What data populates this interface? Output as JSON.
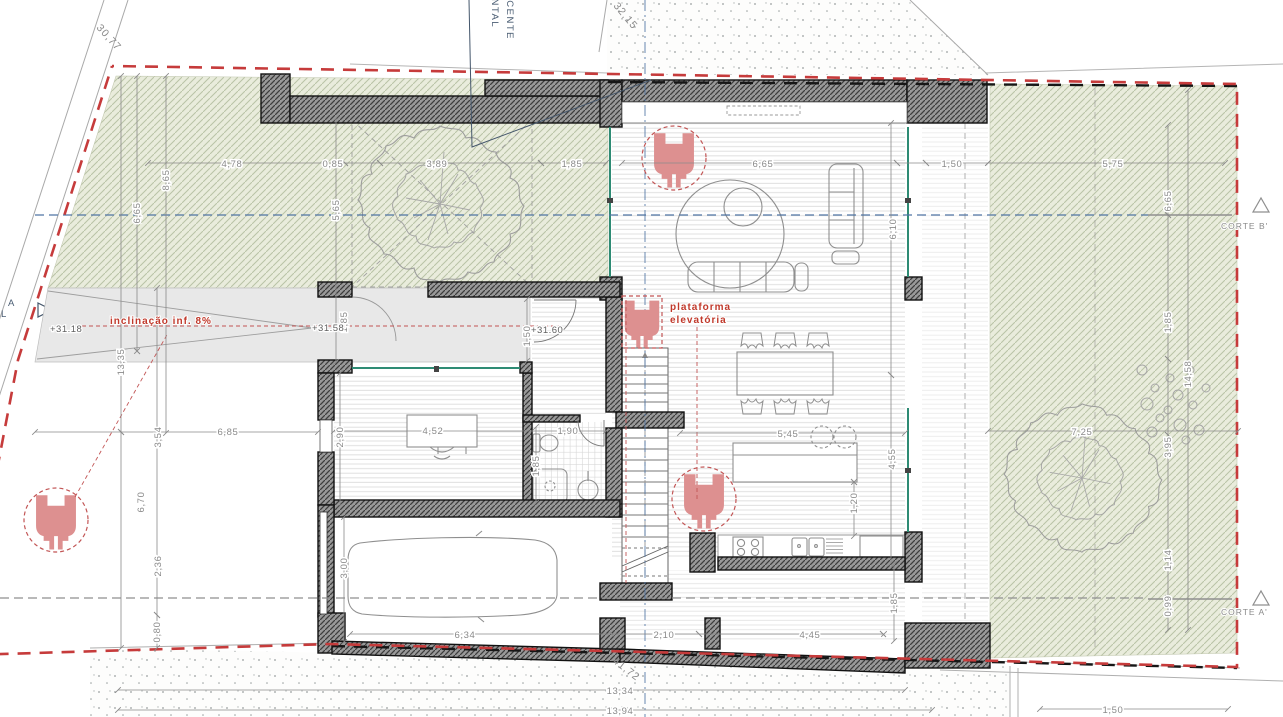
{
  "drawing": {
    "type": "architectural floor plan (ground floor with site)",
    "colors": {
      "boundary_red": "#c63b3b",
      "garden_fill": "#e9ecdc",
      "garden_hatch": "#b9c3a6",
      "wall_fill": "#8f8f8f",
      "wall_hatch": "#3d3d3d",
      "accessibility_red": "#dd9090",
      "note_red": "#c0392b",
      "section_blue": "#4f74a3",
      "glazing_green": "#2e8b74",
      "dim_gray": "#8a8a8a"
    }
  },
  "texts": {
    "frontal": "FRONTAL",
    "adjacente": "ADJACENTE",
    "inclinacao": "inclinação  inf.  8%",
    "plataforma_l1": "plataforma",
    "plataforma_l2": "elevatória",
    "corte_b": "CORTE  B'",
    "corte_a": "CORTE  A'",
    "edge_a": "A",
    "edge_l": "L"
  },
  "levels": {
    "ramp_start": "+31.18",
    "ramp_end": "+31.58",
    "entry_hall": "+31.60"
  },
  "dims": {
    "site_street_left": "30,77",
    "site_street_top": "32,15",
    "site_street_bottom": "41,72",
    "garden_top_1": "4,78",
    "garden_top_2": "0,85",
    "garden_top_3": "3,89",
    "garden_top_4": "1,85",
    "living_width": "6,65",
    "living_east_gap": "1,50",
    "garden_right_top": "5,75",
    "left_v1": "6,65",
    "left_v2": "8,65",
    "left_total": "13,35",
    "garden_sq_h": "5,65",
    "ramp_h": "1,85",
    "west_setback": "6,85",
    "left_v3": "3,54",
    "left_v4": "6,70",
    "left_v5": "2,36",
    "left_v6": "0,80",
    "living_depth": "6,10",
    "kitchen_depth": "4,55",
    "island_w": "5,45",
    "island_off": "1,20",
    "office_w": "4,52",
    "office_d": "2,90",
    "bath_w": "1,90",
    "bath_d": "1,85",
    "entry_d": "1,50",
    "garage_w": "6,34",
    "garage_d": "3,00",
    "patio_gap": "2,10",
    "patio_w": "4,45",
    "patio_d": "1,85",
    "garden_right_w": "7,25",
    "right_v1": "6,65",
    "right_v2": "1,85",
    "right_total": "14,58",
    "right_v3": "3,95",
    "right_v4": "1,14",
    "right_v5": "0,99",
    "bottom_1": "13,34",
    "bottom_2": "13,94",
    "bottom_right": "1,50"
  }
}
